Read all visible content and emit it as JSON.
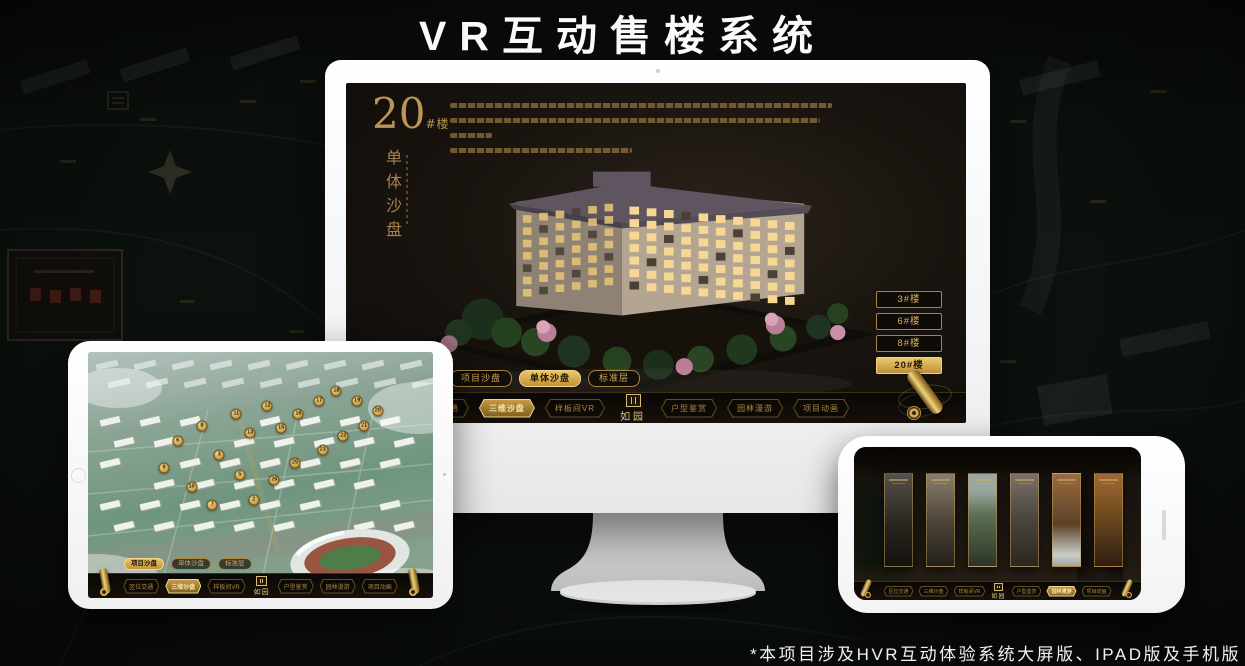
{
  "page": {
    "title": "VR互动售楼系统",
    "footnote": "*本项目涉及HVR互动体验系统大屏版、IPAD版及手机版"
  },
  "colors": {
    "gold": "#c9a457",
    "gold_bright": "#eed47e",
    "background": "#0c110e",
    "screen_dark": "#1b1510"
  },
  "icons": {
    "scroll-icon": "rolled gold scroll ornament (menu handle)",
    "seal-icon": "gold seal mark above logo",
    "compass-icon": "four-point compass star on background map"
  },
  "logo": {
    "name": "如园"
  },
  "monitor": {
    "heading": {
      "number": "20",
      "suffix": "#楼",
      "subtitle": "单体沙盘"
    },
    "building_buttons": [
      {
        "label": "3#楼",
        "active": false
      },
      {
        "label": "6#楼",
        "active": false
      },
      {
        "label": "8#楼",
        "active": false
      },
      {
        "label": "20#楼",
        "active": true
      }
    ],
    "tabs": [
      {
        "label": "项目沙盘",
        "active": false
      },
      {
        "label": "单体沙盘",
        "active": true
      },
      {
        "label": "标准层",
        "active": false
      }
    ],
    "menu": [
      {
        "label": "区位交通",
        "active": false
      },
      {
        "label": "三维沙盘",
        "active": true
      },
      {
        "label": "样板间VR",
        "active": false
      },
      {
        "label": "户型鉴赏",
        "active": false
      },
      {
        "label": "园林漫游",
        "active": false
      },
      {
        "label": "项目动画",
        "active": false
      }
    ]
  },
  "tablet": {
    "tabs": [
      {
        "label": "项目沙盘",
        "active": true
      },
      {
        "label": "单体沙盘",
        "active": false
      },
      {
        "label": "标准层",
        "active": false
      }
    ],
    "menu": [
      {
        "label": "区位交通",
        "active": false
      },
      {
        "label": "三维沙盘",
        "active": true
      },
      {
        "label": "样板间VR",
        "active": false
      },
      {
        "label": "户型鉴赏",
        "active": false
      },
      {
        "label": "园林漫游",
        "active": false
      },
      {
        "label": "项目动画",
        "active": false
      }
    ],
    "badges": [
      {
        "n": "6",
        "x": 26,
        "y": 36
      },
      {
        "n": "8",
        "x": 33,
        "y": 30
      },
      {
        "n": "9",
        "x": 22,
        "y": 47
      },
      {
        "n": "10",
        "x": 30,
        "y": 55
      },
      {
        "n": "11",
        "x": 43,
        "y": 25
      },
      {
        "n": "12",
        "x": 52,
        "y": 22
      },
      {
        "n": "13",
        "x": 47,
        "y": 33
      },
      {
        "n": "15",
        "x": 56,
        "y": 31
      },
      {
        "n": "16",
        "x": 61,
        "y": 25
      },
      {
        "n": "17",
        "x": 67,
        "y": 20
      },
      {
        "n": "18",
        "x": 72,
        "y": 16
      },
      {
        "n": "19",
        "x": 78,
        "y": 20
      },
      {
        "n": "20",
        "x": 84,
        "y": 24
      },
      {
        "n": "21",
        "x": 80,
        "y": 30
      },
      {
        "n": "22",
        "x": 74,
        "y": 34
      },
      {
        "n": "23",
        "x": 68,
        "y": 40
      },
      {
        "n": "25",
        "x": 60,
        "y": 45
      },
      {
        "n": "26",
        "x": 54,
        "y": 52
      },
      {
        "n": "3",
        "x": 38,
        "y": 42
      },
      {
        "n": "5",
        "x": 44,
        "y": 50
      },
      {
        "n": "7",
        "x": 36,
        "y": 62
      },
      {
        "n": "2",
        "x": 48,
        "y": 60
      }
    ]
  },
  "phone": {
    "menu": [
      {
        "label": "区位交通",
        "active": false
      },
      {
        "label": "三维沙盘",
        "active": false
      },
      {
        "label": "样板间VR",
        "active": false
      },
      {
        "label": "户型鉴赏",
        "active": false
      },
      {
        "label": "园林漫游",
        "active": true
      },
      {
        "label": "项目动画",
        "active": false
      }
    ]
  }
}
